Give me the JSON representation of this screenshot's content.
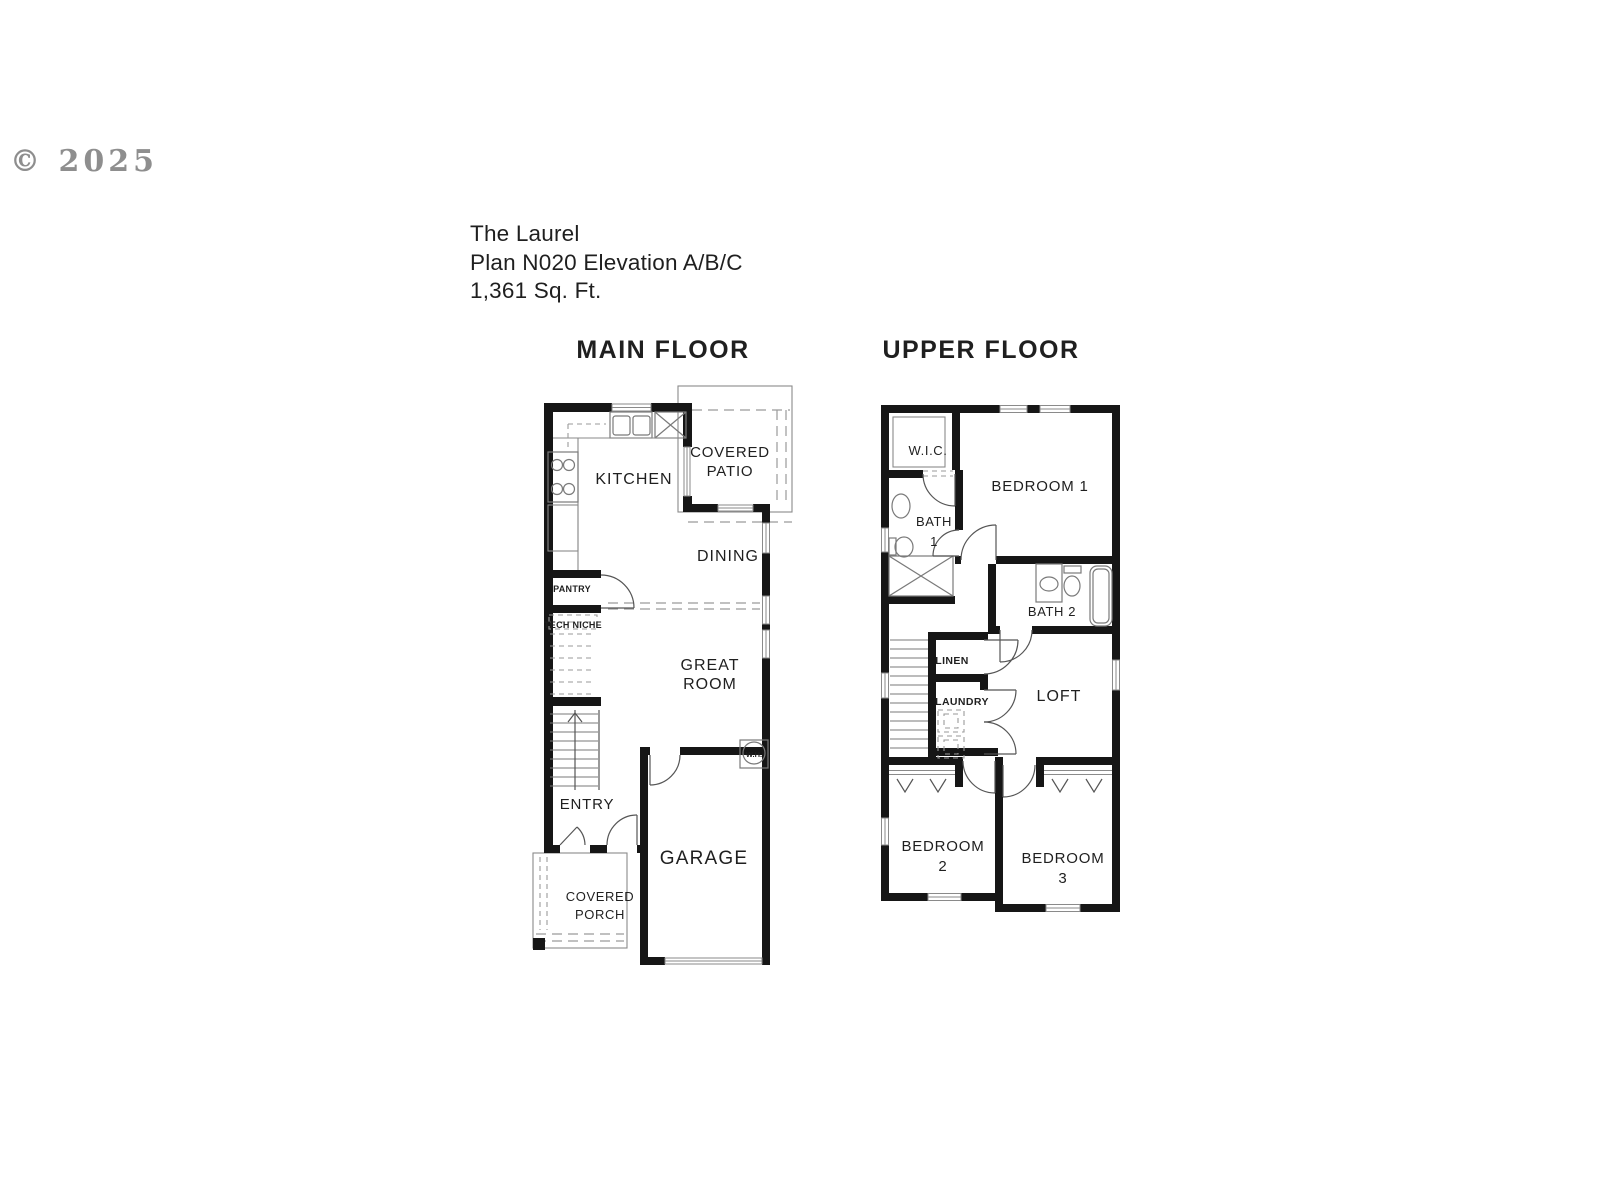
{
  "watermark": "© 2025",
  "title": {
    "name": "The Laurel",
    "plan": "Plan N020 Elevation A/B/C",
    "area": "1,361 Sq. Ft."
  },
  "floors": {
    "main": {
      "heading": "MAIN FLOOR",
      "rooms": {
        "kitchen": "KITCHEN",
        "covered_patio_line1": "COVERED",
        "covered_patio_line2": "PATIO",
        "dining": "DINING",
        "pantry": "PANTRY",
        "tech_niche": "TECH NICHE",
        "great_room_line1": "GREAT",
        "great_room_line2": "ROOM",
        "entry": "ENTRY",
        "garage": "GARAGE",
        "water_heater": "W.H.",
        "covered_porch_line1": "COVERED",
        "covered_porch_line2": "PORCH"
      }
    },
    "upper": {
      "heading": "UPPER FLOOR",
      "rooms": {
        "wic": "W.I.C.",
        "bedroom1": "BEDROOM 1",
        "bath1_line1": "BATH",
        "bath1_line2": "1",
        "bath2": "BATH 2",
        "linen": "LINEN",
        "laundry": "LAUNDRY",
        "loft": "LOFT",
        "bedroom2_line1": "BEDROOM",
        "bedroom2_line2": "2",
        "bedroom3_line1": "BEDROOM",
        "bedroom3_line2": "3"
      }
    }
  },
  "colors": {
    "wall": "#161616",
    "line": "#8a8a8a",
    "fixture": "#7a7a7a",
    "door": "#555555",
    "dash": "#9a9a9a",
    "text": "#1f1f1f",
    "watermark": "#8e8e8e",
    "background": "#ffffff"
  }
}
